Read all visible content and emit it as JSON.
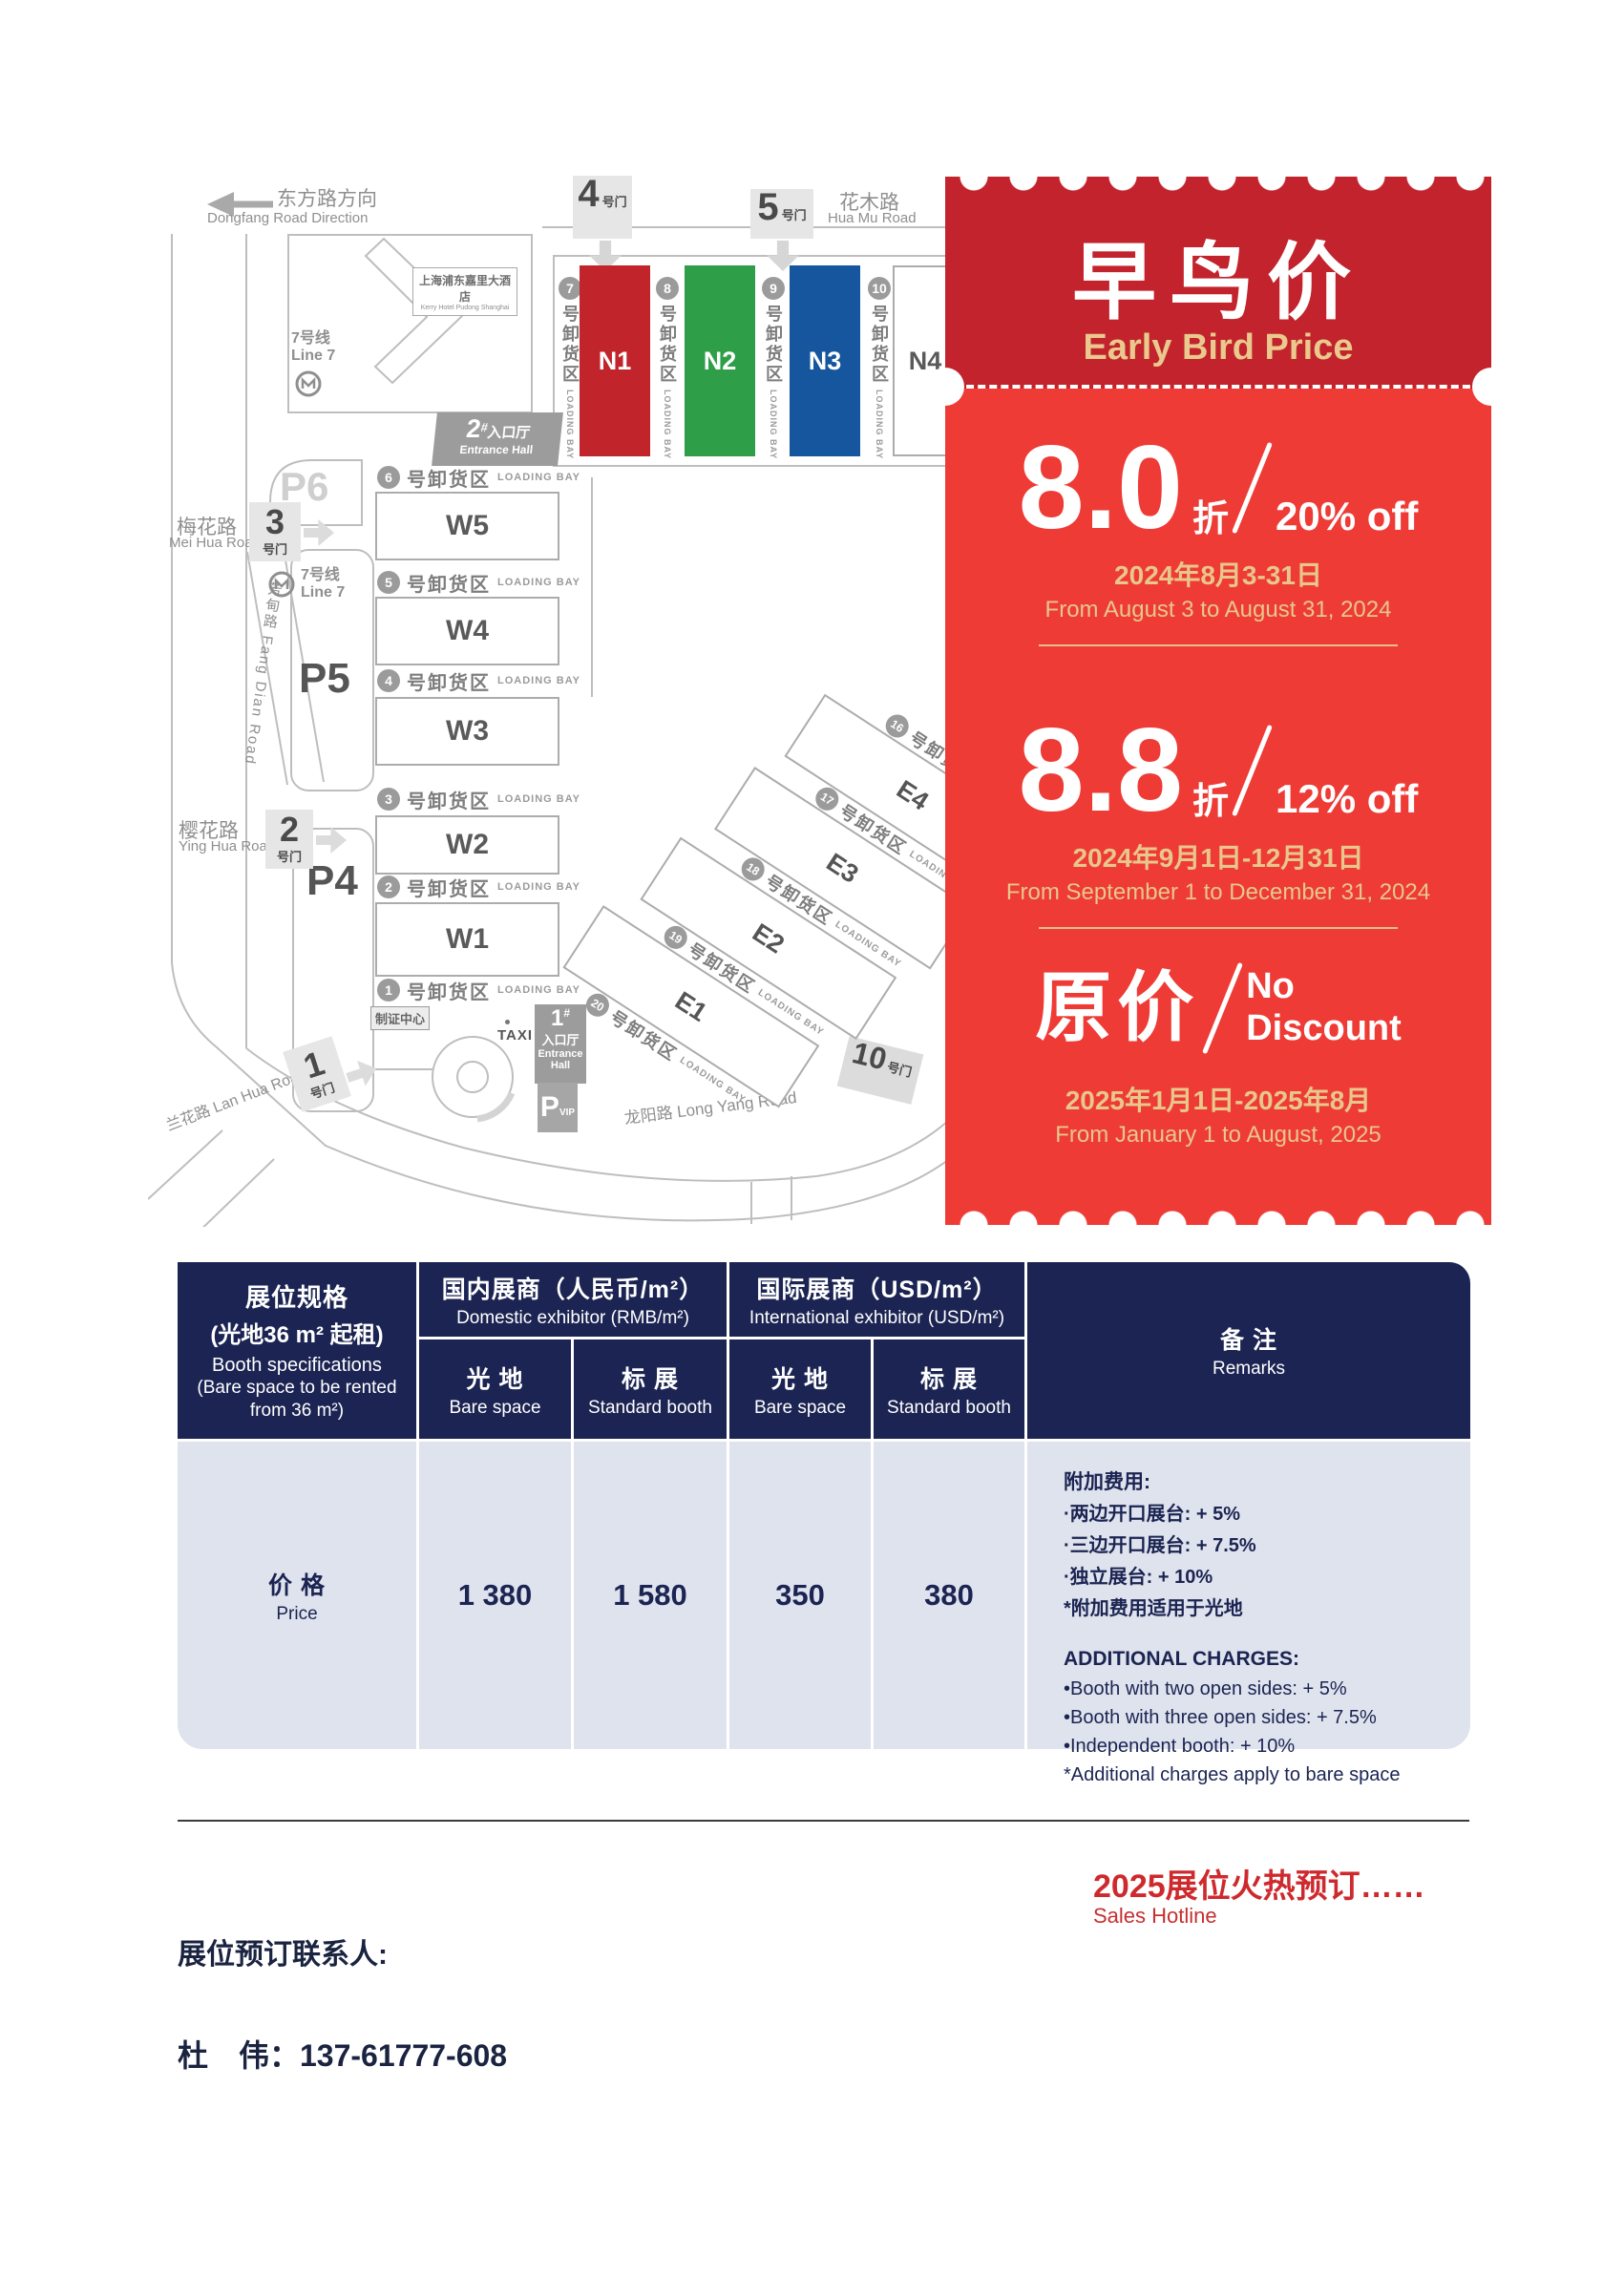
{
  "map": {
    "direction": {
      "zh": "东方路方向",
      "en": "Dongfang Road Direction"
    },
    "hotel": {
      "zh": "上海浦东嘉里大酒店",
      "en": "Kerry Hotel Pudong Shanghai"
    },
    "line7": {
      "zh": "7号线",
      "en": "Line 7"
    },
    "roads": {
      "meihua_zh": "梅花路",
      "meihua_en": "Mei Hua Road",
      "yinghua_zh": "樱花路",
      "yinghua_en": "Ying Hua Road",
      "lanhua": "兰花路 Lan Hua Road",
      "fangdian": "芳甸路 Fang Dian Road",
      "huamu_zh": "花木路",
      "huamu_en": "Hua Mu Road",
      "longyang": "龙阳路 Long Yang Road"
    },
    "gate_suffix": "号门",
    "gates": {
      "g1": "1",
      "g2": "2",
      "g3": "3",
      "g4": "4",
      "g5": "5",
      "g10": "10"
    },
    "parking": {
      "p4": "P4",
      "p5": "P5",
      "p6": "P6",
      "p_letter": "P",
      "vip": "VIP"
    },
    "halls_n": [
      "N1",
      "N2",
      "N3",
      "N4"
    ],
    "halls_w": [
      "W5",
      "W4",
      "W3",
      "W2",
      "W1"
    ],
    "halls_e": [
      "E4",
      "E3",
      "E2",
      "E1"
    ],
    "bays_w": [
      "6",
      "5",
      "4",
      "3",
      "2",
      "1"
    ],
    "bays_n": [
      "7",
      "8",
      "9",
      "10"
    ],
    "bays_e": [
      "16",
      "17",
      "18",
      "19",
      "20"
    ],
    "bay_zh": "号卸货区",
    "bay_en": "LOADING BAY",
    "entrance2": {
      "num": "2",
      "hash": "#",
      "zh": "入口厅",
      "en": "Entrance Hall"
    },
    "entrance1": {
      "num": "1",
      "hash": "#",
      "zh": "入口厅",
      "en1": "Entrance",
      "en2": "Hall"
    },
    "cert": "制证中心",
    "taxi": "TAXI",
    "colors": {
      "n1": "#C2242B",
      "n2": "#2F9E49",
      "n3": "#15569F"
    }
  },
  "ticket": {
    "title_zh": "早鸟价",
    "title_en": "Early Bird Price",
    "tier1": {
      "big": "8.0",
      "zhe": "折",
      "off": "20% off",
      "date_zh": "2024年8月3-31日",
      "date_en": "From August 3 to August 31, 2024"
    },
    "tier2": {
      "big": "8.8",
      "zhe": "折",
      "off": "12% off",
      "date_zh": "2024年9月1日-12月31日",
      "date_en": "From September 1 to December 31, 2024"
    },
    "tier3": {
      "big": "原价",
      "no1": "No",
      "no2": "Discount",
      "date_zh": "2025年1月1日-2025年8月",
      "date_en": "From January 1 to August, 2025"
    },
    "colors": {
      "header": "#C2232C",
      "body": "#EE3B36",
      "gold": "#E8C78C"
    }
  },
  "pricing_table": {
    "spec": {
      "zh1": "展位规格",
      "zh2": "(光地36 m² 起租)",
      "en1": "Booth specifications",
      "en2": "(Bare space to be rented",
      "en3": "from 36 m²)"
    },
    "domestic": {
      "zh": "国内展商（人民币/m²）",
      "en": "Domestic exhibitor (RMB/m²)"
    },
    "international": {
      "zh": "国际展商（USD/m²）",
      "en": "International exhibitor (USD/m²)"
    },
    "bare": {
      "zh": "光 地",
      "en": "Bare space"
    },
    "standard": {
      "zh": "标 展",
      "en": "Standard booth"
    },
    "remarks": {
      "zh": "备 注",
      "en": "Remarks"
    },
    "price": {
      "zh": "价 格",
      "en": "Price",
      "domestic_bare": "1 380",
      "domestic_std": "1 580",
      "intl_bare": "350",
      "intl_std": "380"
    },
    "remarks_body": {
      "cn_title": "附加费用:",
      "cn1": "·两边开口展台: + 5%",
      "cn2": "·三边开口展台: + 7.5%",
      "cn3": "·独立展台: + 10%",
      "cn4": "*附加费用适用于光地",
      "en_title": "ADDITIONAL CHARGES:",
      "en1": "•Booth with two open sides: + 5%",
      "en2": "•Booth with three open sides: + 7.5%",
      "en3": "•Independent booth: + 10%",
      "en4": "*Additional charges apply to bare space"
    }
  },
  "footer": {
    "hot_title": "2025展位火热预订……",
    "hot_sub": "Sales Hotline",
    "contact_label": "展位预订联系人:",
    "contact_phone": "杜　伟：137-61777-608"
  }
}
